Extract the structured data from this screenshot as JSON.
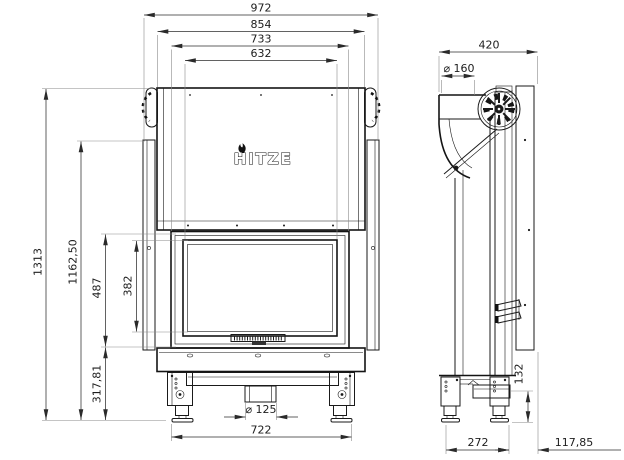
{
  "drawing": {
    "brand_logo": "HITZE",
    "front_view": {
      "dims": {
        "overall_width": "972",
        "hood_width": "854",
        "door_width": "733",
        "glass_width": "632",
        "overall_height": "1313",
        "side_panel_height": "1162,50",
        "door_height": "487",
        "glass_height": "382",
        "base_height": "317,81",
        "feet_span": "722",
        "intake_diameter": "⌀ 125"
      }
    },
    "side_view": {
      "dims": {
        "depth": "420",
        "flue_diameter": "⌀ 160",
        "rear_base_height": "132",
        "feet_span": "272",
        "rear_offset": "117,85"
      }
    }
  }
}
